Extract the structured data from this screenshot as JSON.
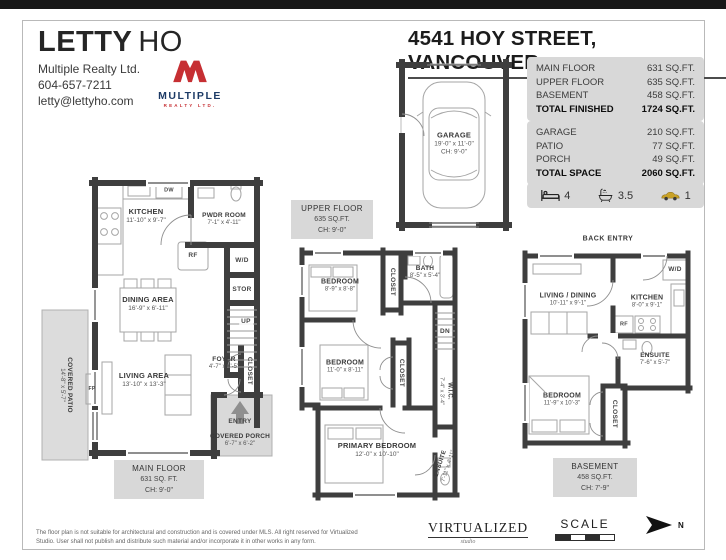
{
  "agent": {
    "first": "LETTY",
    "last": "HO",
    "brokerage": "Multiple Realty Ltd.",
    "phone": "604-657-7211",
    "email": "letty@lettyho.com"
  },
  "logo": {
    "name": "MULTIPLE",
    "sub": "REALTY LTD.",
    "red": "#c62f33",
    "navy": "#1d3b66"
  },
  "address": "4541 HOY STREET, VANCOUVER",
  "area_tables": {
    "finished": {
      "rows": [
        {
          "label": "MAIN FLOOR",
          "value": "631 SQ.FT."
        },
        {
          "label": "UPPER FLOOR",
          "value": "635 SQ.FT."
        },
        {
          "label": "BASEMENT",
          "value": "458 SQ.FT."
        },
        {
          "label": "TOTAL FINISHED",
          "value": "1724 SQ.FT."
        }
      ]
    },
    "space": {
      "rows": [
        {
          "label": "GARAGE",
          "value": "210 SQ.FT."
        },
        {
          "label": "PATIO",
          "value": "77 SQ.FT."
        },
        {
          "label": "PORCH",
          "value": "49 SQ.FT."
        },
        {
          "label": "TOTAL SPACE",
          "value": "2060 SQ.FT."
        }
      ]
    }
  },
  "stats": {
    "beds": "4",
    "baths": "3.5",
    "parking": "1"
  },
  "garage": {
    "name": "GARAGE",
    "dims": "19'-0\" x 11'-0\"",
    "ch": "CH: 9'-0\""
  },
  "main_floor": {
    "plan_label": {
      "line1": "MAIN FLOOR",
      "line2": "631 SQ. FT.",
      "line3": "CH: 9'-0\""
    },
    "rooms": {
      "kitchen": {
        "name": "KITCHEN",
        "dims": "11'-10\" x 9'-7\""
      },
      "pwdr": {
        "name": "PWDR ROOM",
        "dims": "7'-1\" x 4'-11\""
      },
      "dining": {
        "name": "DINING AREA",
        "dims": "16'-9\" x 6'-11\""
      },
      "living": {
        "name": "LIVING AREA",
        "dims": "13'-10\" x 13'-3\""
      },
      "foyer": {
        "name": "FOYER",
        "dims": "4'-7\" x 4'-5\""
      },
      "porch": {
        "name": "COVERED PORCH",
        "dims": "6'-7\" x 6'-2\""
      },
      "patio": {
        "name": "COVERED PATIO",
        "dims": "14'-8\" x 5'-7\""
      }
    },
    "tags": {
      "dw": "DW",
      "rf": "RF",
      "wd": "W/D",
      "stor": "STOR",
      "up": "UP",
      "fp": "FP",
      "closet": "CLOSET",
      "entry": "ENTRY"
    }
  },
  "upper_floor": {
    "plan_label": {
      "line1": "UPPER FLOOR",
      "line2": "635 SQ.FT.",
      "line3": "CH: 9'-0\""
    },
    "rooms": {
      "bedroom1": {
        "name": "BEDROOM",
        "dims": "8'-9\" x 8'-8\""
      },
      "bath": {
        "name": "BATH",
        "dims": "8'-5\" x 5'-4\""
      },
      "bedroom2": {
        "name": "BEDROOM",
        "dims": "11'-0\" x 8'-11\""
      },
      "wic": {
        "name": "W.I.C.",
        "dims": "7'-4\" x 3'-4\""
      },
      "primary": {
        "name": "PRIMARY BEDROOM",
        "dims": "12'-0\" x 10'-10\""
      },
      "ensuite": {
        "name": "ENSUITE",
        "dims": "7'-11\" x 4'-11\""
      }
    },
    "tags": {
      "closet1": "CLOSET",
      "closet2": "CLOSET",
      "dn": "DN"
    }
  },
  "basement": {
    "back_entry": "BACK ENTRY",
    "plan_label": {
      "line1": "BASEMENT",
      "line2": "458 SQ.FT.",
      "line3": "CH: 7'-9\""
    },
    "rooms": {
      "livdin": {
        "name": "LIVING / DINING",
        "dims": "10'-11\" x 9'-1\""
      },
      "kitchen": {
        "name": "KITCHEN",
        "dims": "8'-0\" x 9'-1\""
      },
      "ensuite": {
        "name": "ENSUITE",
        "dims": "7'-6\" x 5'-7\""
      },
      "bedroom": {
        "name": "BEDROOM",
        "dims": "11'-9\" x 10'-3\""
      }
    },
    "tags": {
      "wd": "W/D",
      "rf": "RF",
      "closet": "CLOSET"
    }
  },
  "footer": {
    "disclaimer_line1": "The floor plan is not suitable for architectural and construction and is covered under MLS. All right reserved for Virtualized",
    "disclaimer_line2": "Studio. User shall not publish and distribute such material and/or incorporate it in other works in any form.",
    "studio": "VIRTUALIZED",
    "studio_sub": "studio",
    "scale_label": "SCALE",
    "north_label": "N"
  }
}
